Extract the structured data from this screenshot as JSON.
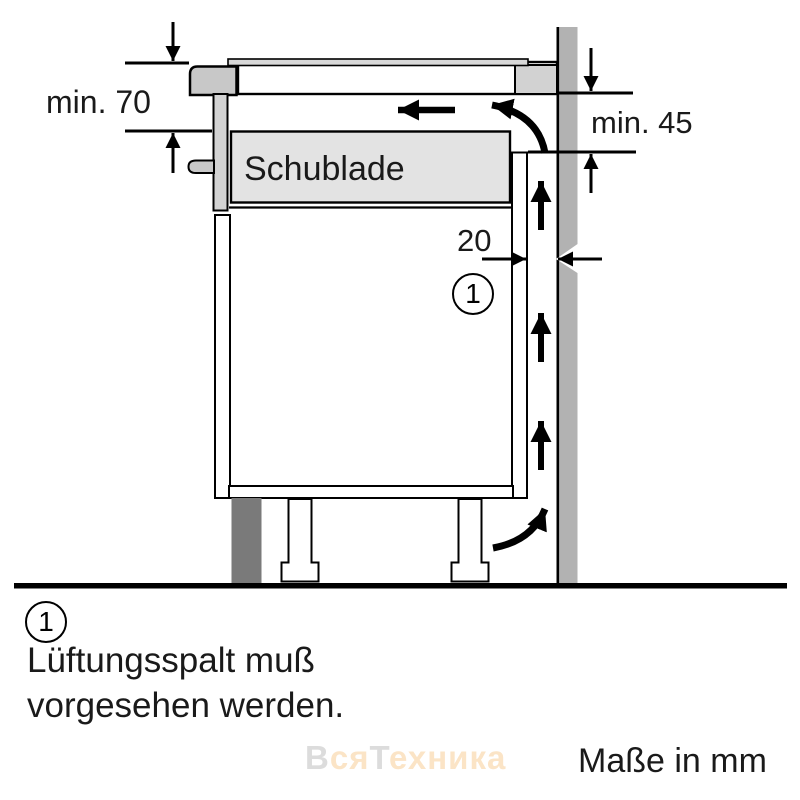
{
  "diagram": {
    "labels": {
      "dim_top_left": "min. 70",
      "dim_top_right": "min. 45",
      "dim_gap": "20",
      "drawer": "Schublade",
      "callout_number": "1"
    },
    "legend": {
      "number": "1",
      "line1": "Lüftungsspalt muß",
      "line2": "vorgesehen werden."
    },
    "footer": {
      "units_note": "Maße in mm"
    },
    "watermark": {
      "parts": [
        {
          "text": "В",
          "tone": "gray"
        },
        {
          "text": "ся",
          "tone": "orange"
        },
        {
          "text": "Т",
          "tone": "gray"
        },
        {
          "text": "ехника",
          "tone": "orange"
        }
      ]
    },
    "colors": {
      "line": "#000000",
      "wall_gray": "#b2b2b2",
      "hob_gray": "#c8c8c8",
      "panel_light_gray": "#d3d3d3",
      "drawer_fill": "#e3e3e3",
      "plinth_dark_gray": "#7a7a7a",
      "watermark_gray": "#dcdcdc",
      "watermark_orange": "#fbe4c6"
    }
  }
}
